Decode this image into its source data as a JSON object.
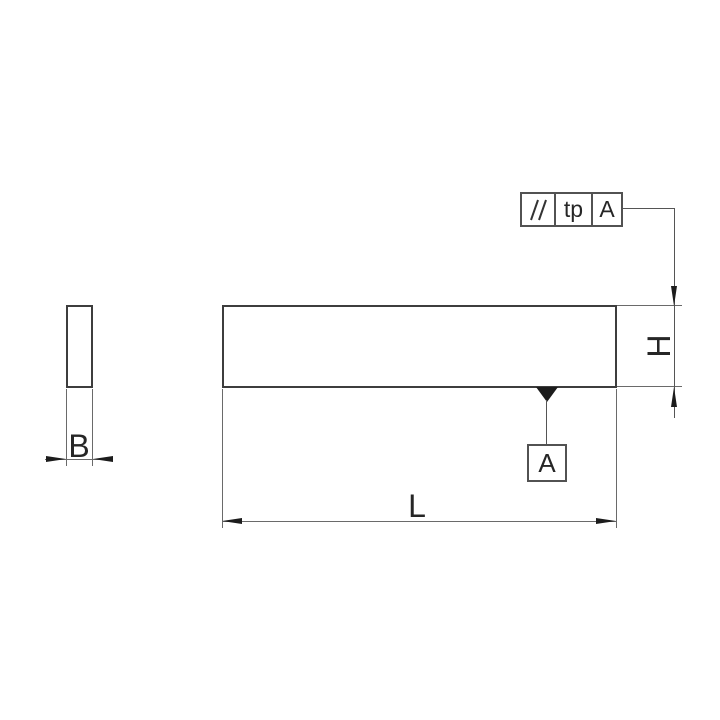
{
  "drawing": {
    "title": "parallel block two views with parallelism tolerance",
    "views": {
      "side_view": {
        "dimension_label": "B"
      },
      "front_view": {
        "length_label": "L",
        "height_label": "H"
      }
    },
    "feature_control_frame": {
      "symbol": "//",
      "symbol_name": "parallelism",
      "tolerance": "tp",
      "datum_ref": "A"
    },
    "datum_feature": {
      "label": "A"
    },
    "colors": {
      "background": "#ffffff",
      "outline": "#3d3d3d",
      "thin_line": "#6a6a6a",
      "arrow": "#1c1c1c",
      "text": "#262626",
      "frame_border": "#525252"
    }
  }
}
